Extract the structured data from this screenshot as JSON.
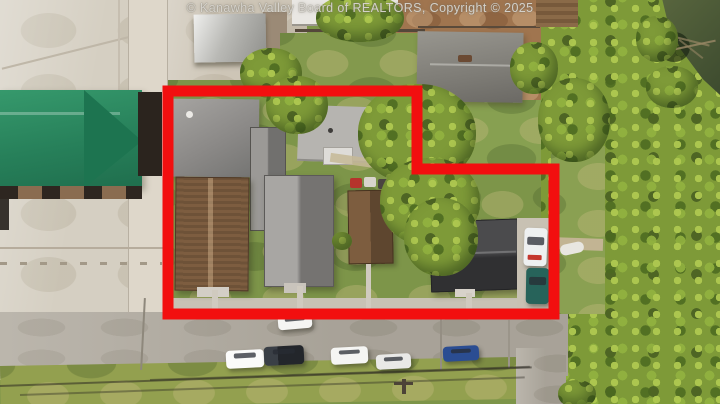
{
  "watermark": {
    "text": "© Kanawha Valley Board of REALTORS, Copyright © 2025"
  },
  "annotation": {
    "boundary_color": "#f20f0f",
    "boundary_stroke_width": 11,
    "boundary_points": "168,91 417,91 417,169 554,169 554,314 168,314"
  },
  "scene": {
    "type": "aerial-photo",
    "palette": {
      "pavement": "#d5cfc2",
      "street": "#b2aca1",
      "lawn": "#7d9549",
      "foliage": "#7e9a38",
      "dirt": "#a0754f",
      "water": "#465433",
      "green_metal_roof": "#2e8f63"
    }
  }
}
